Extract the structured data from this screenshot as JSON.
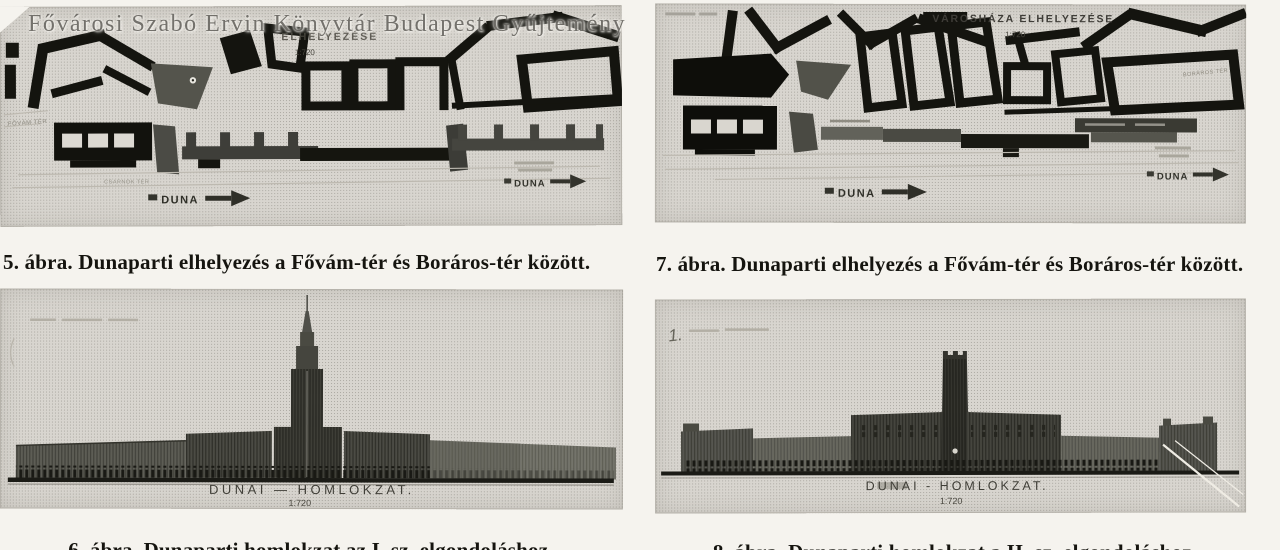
{
  "palette": {
    "paper": "#f5f3ee",
    "ink": "#15140f",
    "halftone": "#d8d5cf"
  },
  "page": {
    "watermark": "Fővárosi Szabó Ervin Könyvtár Budapest Gyűjtemény"
  },
  "figures": [
    {
      "id": "fig5",
      "caption": "5. ábra. Dunaparti elhelyezés a Fővám-tér és Boráros-tér között.",
      "map": {
        "title": "ELHELYEZÉSE",
        "scale": "1:720",
        "river_label": "DUNA",
        "square_label": "FŐVÁM TÉR",
        "district_label": "CSARNOK TÉR"
      }
    },
    {
      "id": "fig7",
      "caption": "7. ábra. Dunaparti elhelyezés a Fővám-tér és Boráros-tér között.",
      "map": {
        "title": "VÁROSHÁZA ELHELYEZÉSE",
        "scale": "1:720",
        "river_label": "DUNA",
        "square_label": "BORÁROS TÉR"
      }
    },
    {
      "id": "fig6",
      "caption": "6. ábra. Dunaparti homlokzat az I. sz. elgondoláshoz.",
      "elevation": {
        "label": "DUNAI — HOMLOKZAT.",
        "scale": "1:720"
      }
    },
    {
      "id": "fig8",
      "caption": "8. ábra. Dunaparti homlokzat a II. sz. elgondoláshoz.",
      "elevation": {
        "label": "DUNAI - HOMLOKZAT.",
        "scale": "1:720",
        "note": "1."
      }
    }
  ]
}
